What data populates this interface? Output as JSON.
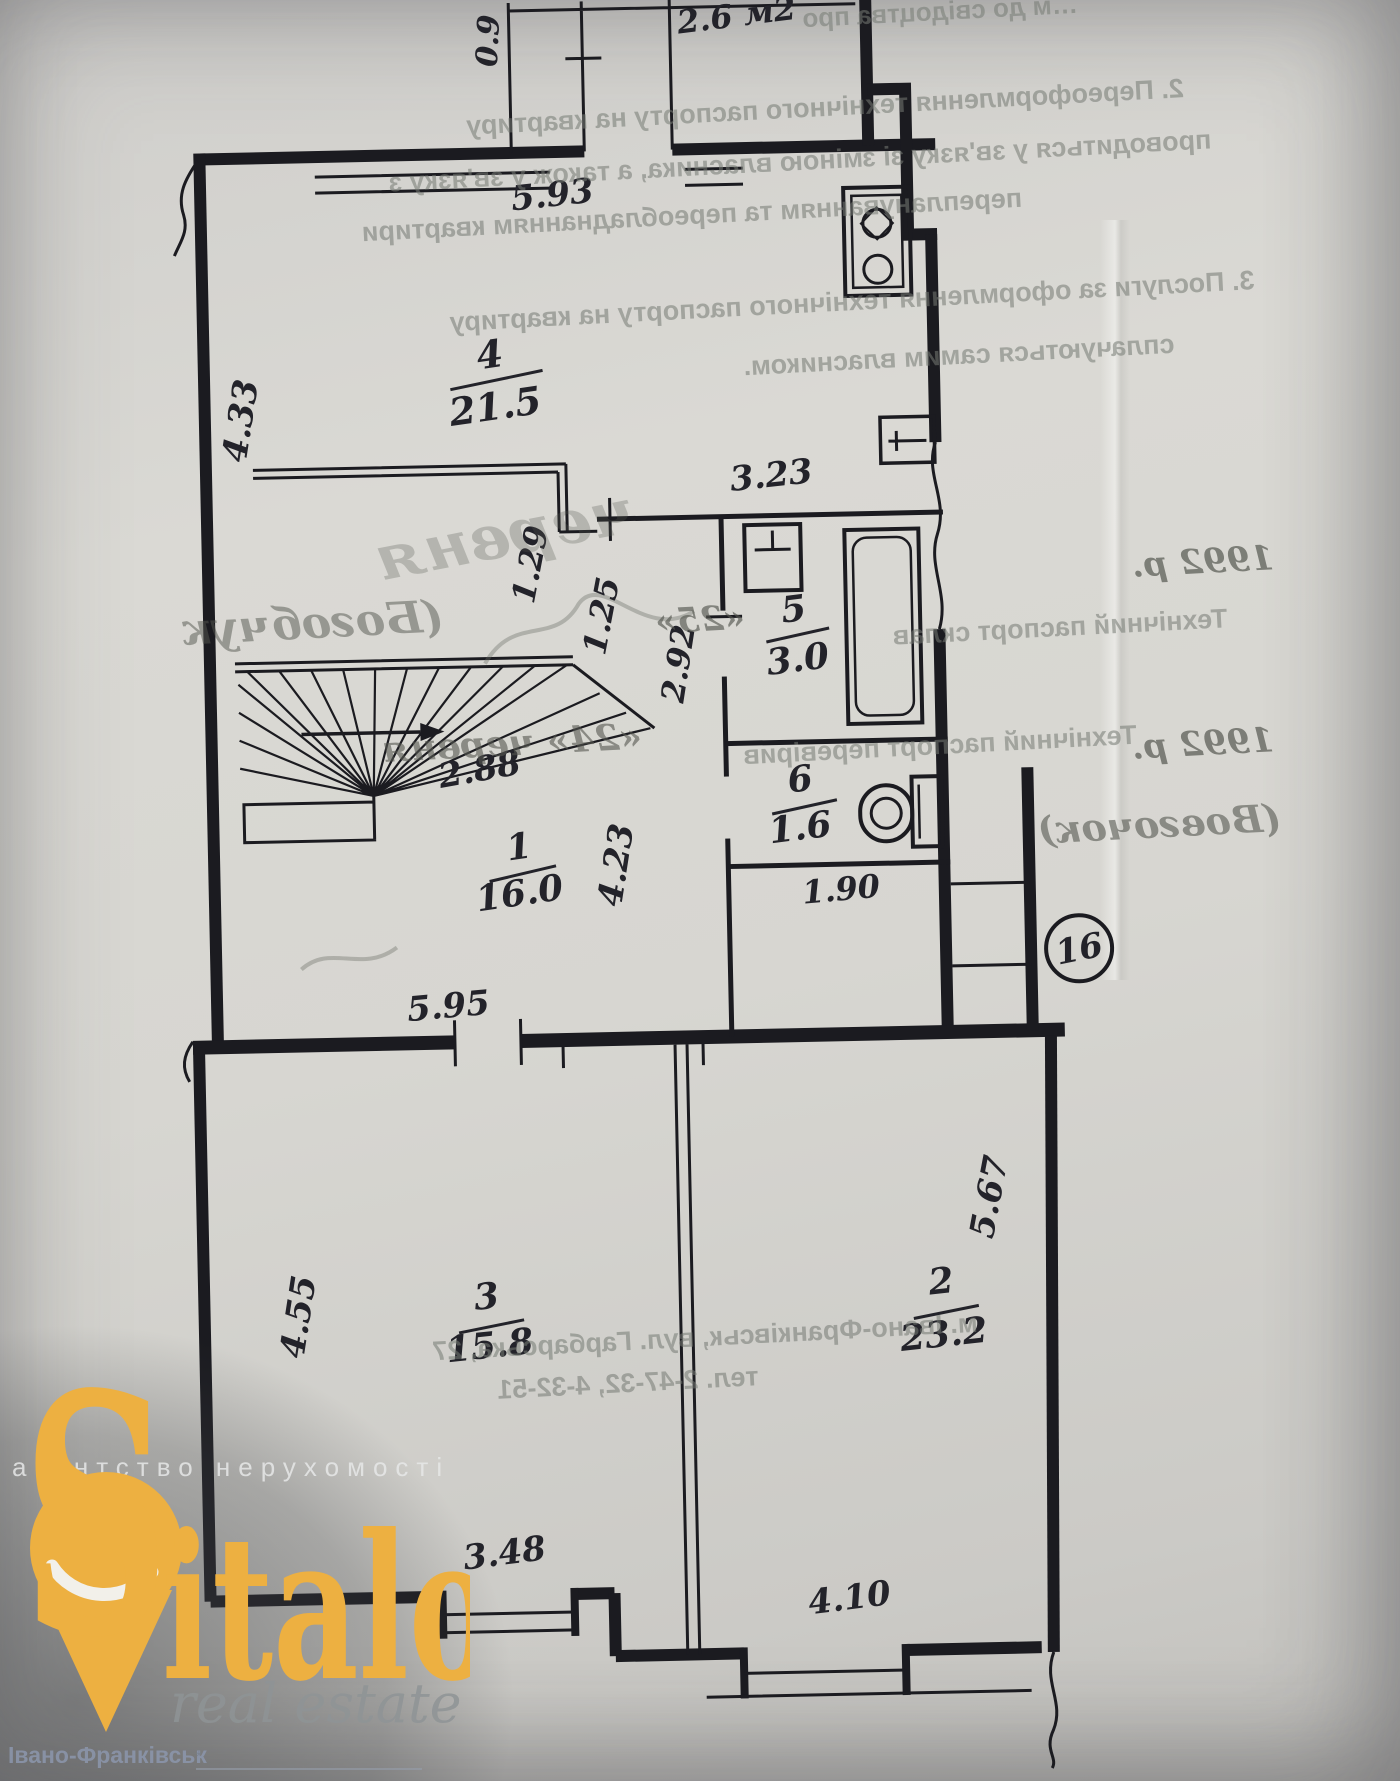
{
  "plan": {
    "apartment_number": "16",
    "rooms": {
      "kitchen": {
        "number": "4",
        "area": "21.5"
      },
      "bath": {
        "number": "5",
        "area": "3.0"
      },
      "wc": {
        "number": "6",
        "area": "1.6"
      },
      "hall": {
        "number": "1",
        "area": "16.0"
      },
      "room3": {
        "number": "3",
        "area": "15.8"
      },
      "room2": {
        "number": "2",
        "area": "23.2"
      }
    },
    "dims": {
      "d593": "5.93",
      "d09": "0.9",
      "balcony_area": "2.6 м2",
      "d433": "4.33",
      "d323": "3.23",
      "d129": "1.29",
      "d125": "1.25",
      "d292": "2.92",
      "d288": "2.88",
      "d423": "4.23",
      "d190": "1.90",
      "d595": "5.95",
      "d455": "4.55",
      "d567": "5.67",
      "d348": "3.48",
      "d410": "4.10"
    }
  },
  "bleed": {
    "top_fragment": "…м до свідоцтва про",
    "clause2": [
      "2. Переоформлення технічного паспорту на квартиру",
      "проводиться у зв'язку зі зміною власника, а також у зв'язку з",
      "переплануванням та переобладнанням квартири"
    ],
    "clause3": [
      "3. Послуги за оформлення технічного паспорту на квартиру",
      "сплачуються самим власником."
    ],
    "made_label": "Технічний паспорт склав",
    "made_day": "«25»",
    "made_month": "червня",
    "made_year": "1992 р.",
    "made_name": "(Богобчук",
    "checked_label": "Технічний паспорт перевірив",
    "checked_day": "«24» червня",
    "checked_year": "1992 р.",
    "checked_name": "(Вовгочок)",
    "address": "м. Івано-Франківськ, вул. Гарбарська, 27",
    "phone": "тел. 2-47-32, 4-32-51"
  },
  "watermark": {
    "agency": "агентство нерухомості",
    "brand_s": "S",
    "brand_rest": "italo",
    "brand_sub": "real estate",
    "city": "Івано-Франківськ",
    "brand_color": "#edb041"
  }
}
